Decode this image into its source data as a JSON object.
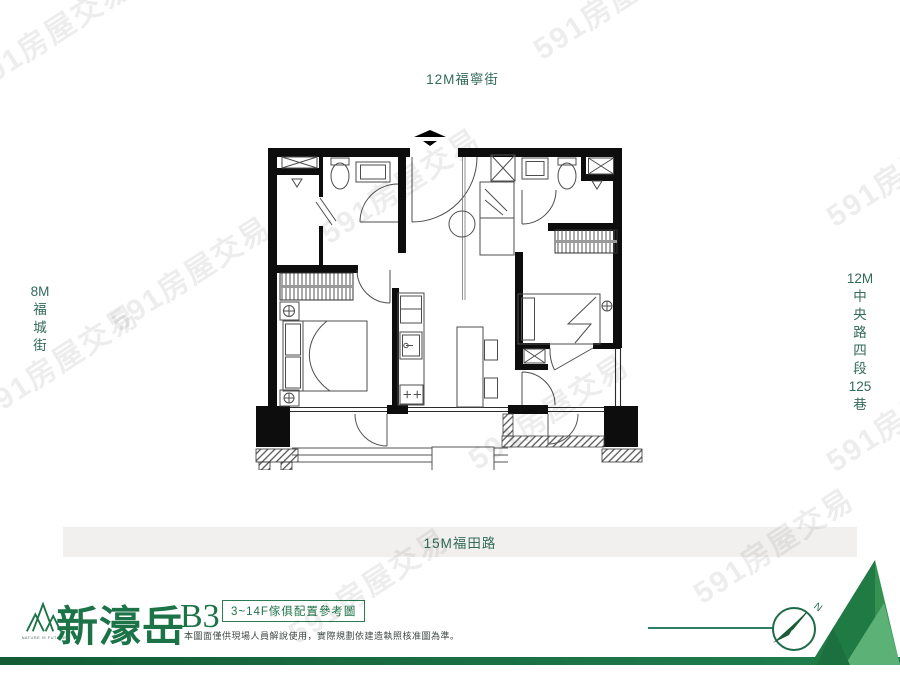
{
  "watermark": {
    "text": "591房屋交易"
  },
  "streets": {
    "top": "12M福寧街",
    "left_lines": [
      "8M",
      "福",
      "城",
      "街"
    ],
    "right_lines": [
      "12M",
      "中",
      "央",
      "路",
      "四",
      "段",
      "125",
      "巷"
    ],
    "bottom": "15M福田路"
  },
  "footer": {
    "logo_caption": "NATURE IS FUTURE",
    "project_name": "新濠岳",
    "unit_label": "B3",
    "badge": "3~14F傢俱配置參考圖",
    "disclaimer": "本圖面僅供現場人員解說使用，實際規劃依建造執照核准圖為準。",
    "compass_label": "N"
  },
  "colors": {
    "brand_green": "#1c7348",
    "street_label": "#336b5b",
    "road_band": "#f1f0ee",
    "footer_band": "#17663c",
    "wall_black": "#0d0d0d"
  }
}
